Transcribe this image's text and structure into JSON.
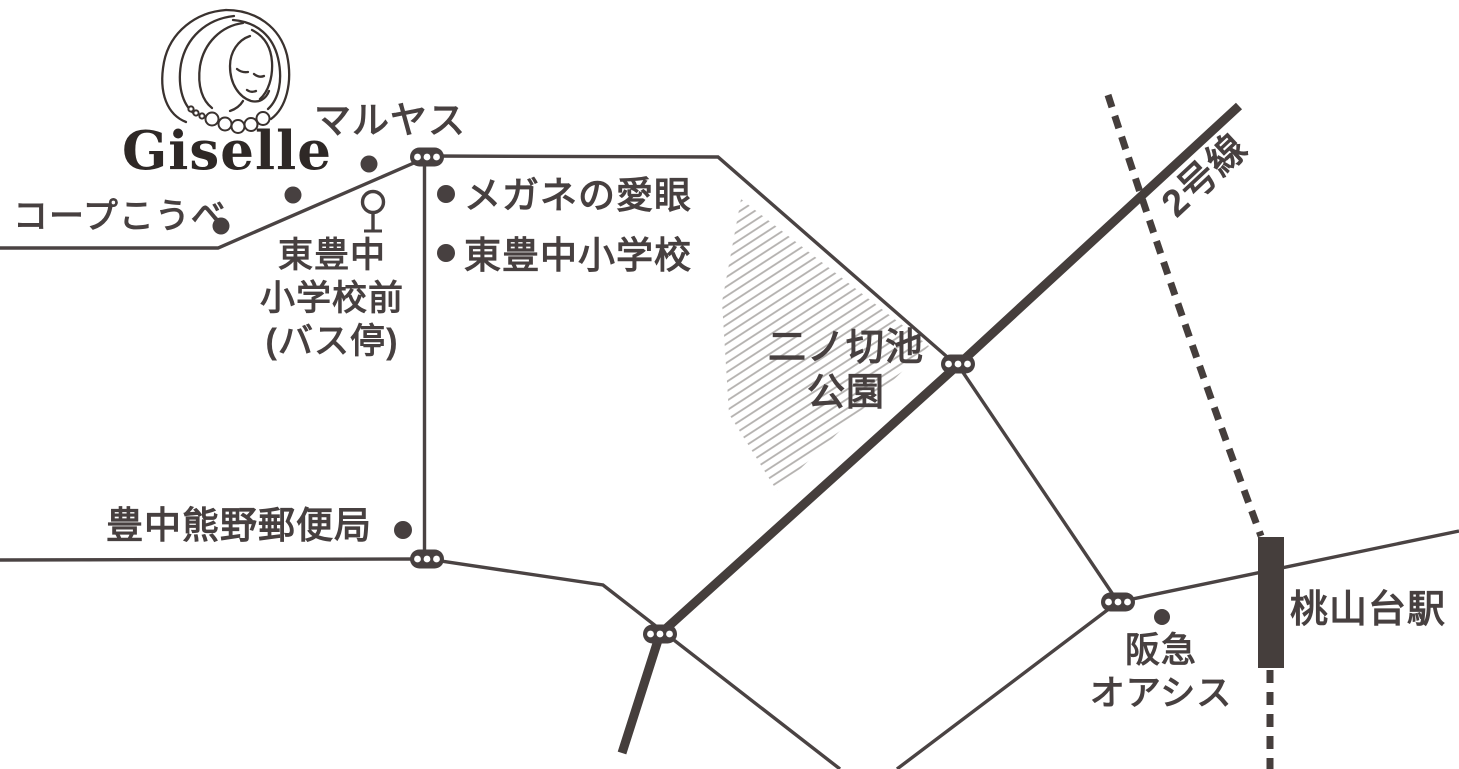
{
  "map": {
    "brand": {
      "name": "Giselle"
    },
    "labels": {
      "maruyasu": "マルヤス",
      "coop_kobe": "コープこうべ",
      "megane_aigan": "メガネの愛眼",
      "higashitoyonaka_elementary": "東豊中小学校",
      "bus_stop": "東豊中\n小学校前\n(バス停)",
      "post_office": "豊中熊野郵便局",
      "park": "二ノ切池\n公園",
      "route2": "2号線",
      "hankyu_oasis": "阪急\nオアシス",
      "momoyamadai_station": "桃山台駅"
    },
    "icons": {
      "traffic_light": "traffic-light-icon",
      "bus_stop": "bus-stop-icon",
      "station_bar": "station-bar-icon",
      "portrait": "portrait-icon",
      "place_dot": "place-dot"
    },
    "colors": {
      "ink": "#474040",
      "thin_road": "#4a4343",
      "hatch": "#b3b0ae",
      "background": "#ffffff"
    }
  }
}
